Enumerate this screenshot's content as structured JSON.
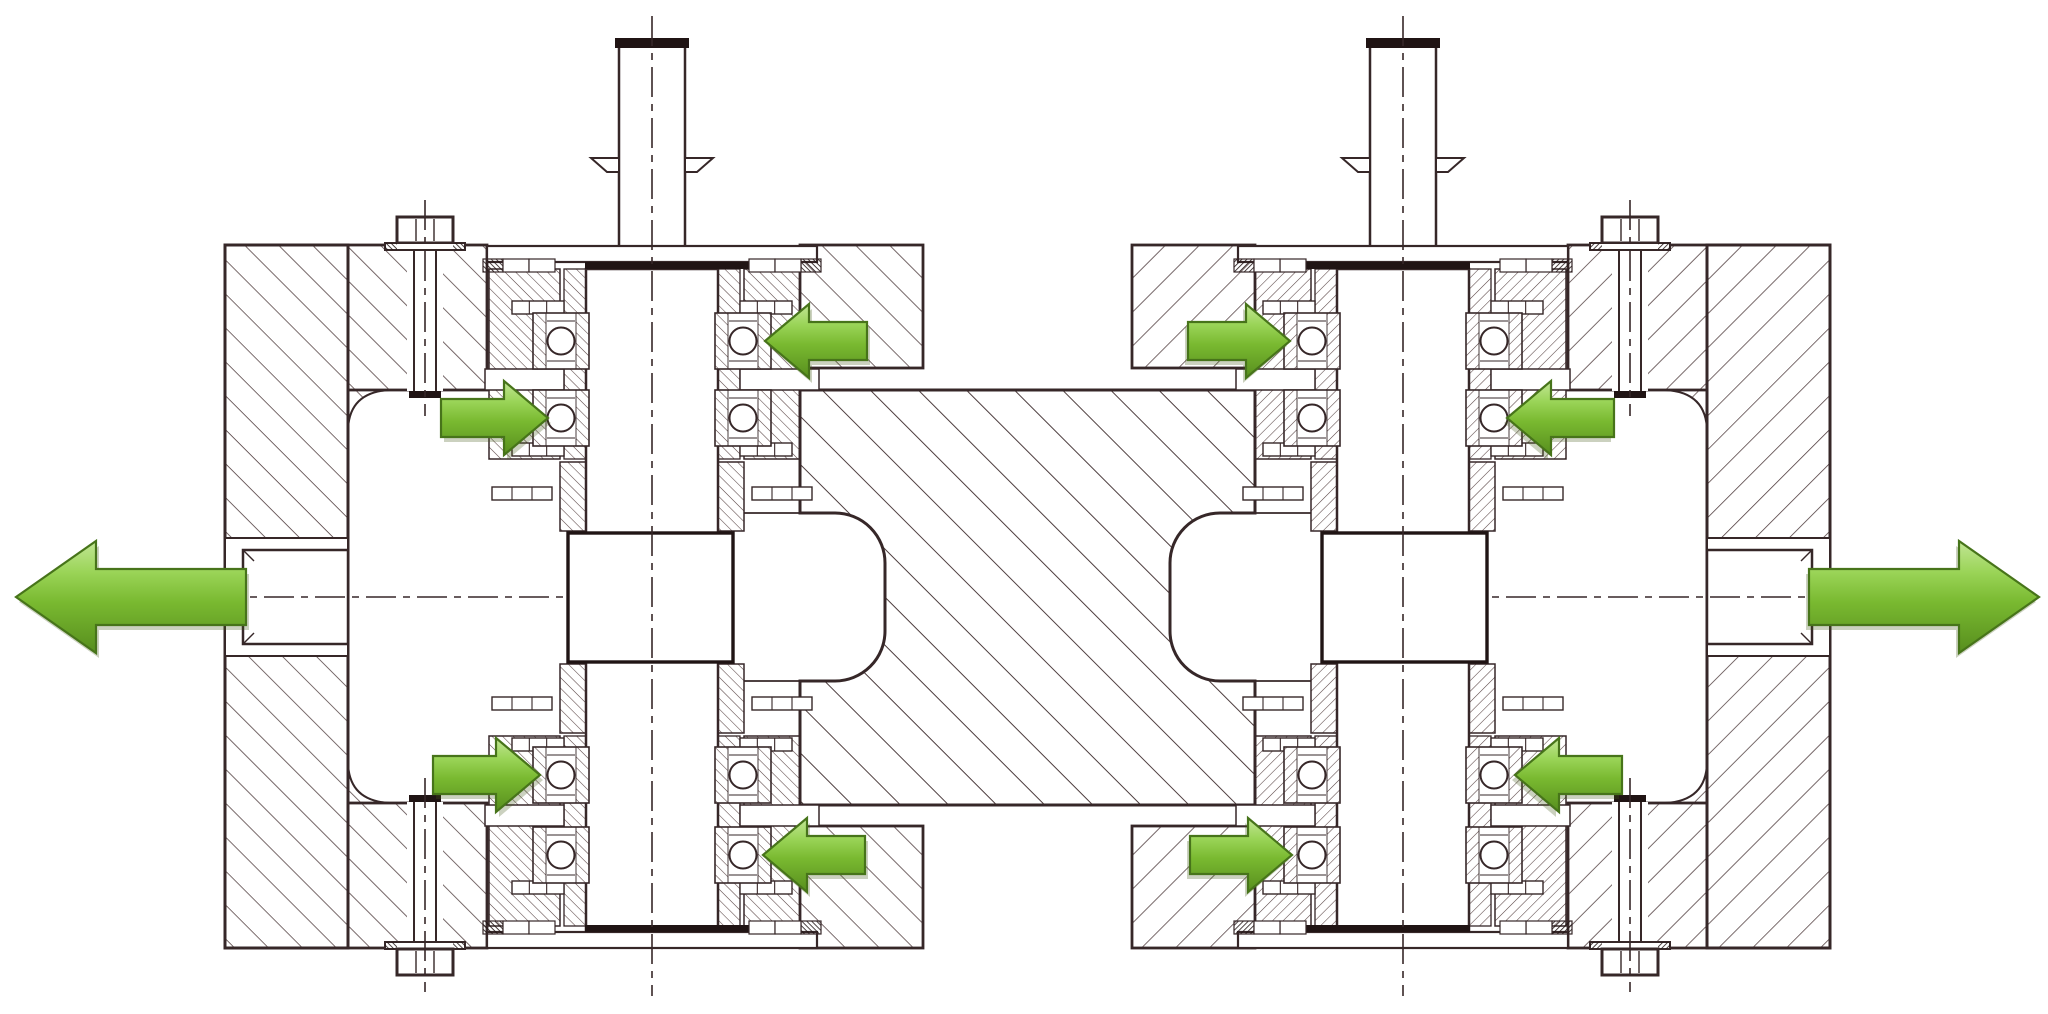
{
  "diagram": {
    "type": "engineering_cross_section",
    "subject": "Sectional drawing of a symmetric twin-shaft four-bearing test rig with green force-flow arrows",
    "canvas": {
      "width": 2048,
      "height": 1014,
      "background": "#ffffff"
    },
    "colors": {
      "line": "#362728",
      "bold": "#201414",
      "hatch_coarse": "#4b3839",
      "hatch_block": "#443334",
      "hatch_fine": "#574242",
      "white": "#ffffff",
      "arrow_highlight": "#c2e695",
      "arrow_light": "#9ad457",
      "arrow_body": "#79b930",
      "arrow_shade": "#578e1e",
      "arrow_outline": "#47741a",
      "arrow_shadow": "rgba(70,90,25,0.28)"
    },
    "mirror_axis_x": 1027.5,
    "shafts": [
      {
        "id": "shaft-left",
        "center_x": 652
      },
      {
        "id": "shaft-right",
        "center_x": 1403,
        "mirrored_from": "shaft-left"
      }
    ],
    "bearing_rows_y": [
      341,
      418,
      775,
      855
    ],
    "ball_offset_x": 91,
    "ball_radius": 13.5,
    "axial_force_arrows": [
      {
        "id": "arrow-l1",
        "shaft": "shaft-left",
        "row_y": 341,
        "direction": "left",
        "tip_x": 765,
        "length": 102
      },
      {
        "id": "arrow-l2",
        "shaft": "shaft-left",
        "row_y": 418,
        "direction": "right",
        "tip_x": 548,
        "length": 107
      },
      {
        "id": "arrow-l3",
        "shaft": "shaft-left",
        "row_y": 775,
        "direction": "right",
        "tip_x": 540,
        "length": 107
      },
      {
        "id": "arrow-l4",
        "shaft": "shaft-left",
        "row_y": 855,
        "direction": "left",
        "tip_x": 763,
        "length": 102
      },
      {
        "id": "arrow-r1",
        "shaft": "shaft-right",
        "row_y": 341,
        "direction": "right",
        "tip_x": 1290,
        "length": 102,
        "mirrored_from": "arrow-l1"
      },
      {
        "id": "arrow-r2",
        "shaft": "shaft-right",
        "row_y": 418,
        "direction": "left",
        "tip_x": 1507,
        "length": 107,
        "mirrored_from": "arrow-l2"
      },
      {
        "id": "arrow-r3",
        "shaft": "shaft-right",
        "row_y": 775,
        "direction": "left",
        "tip_x": 1515,
        "length": 107,
        "mirrored_from": "arrow-l3"
      },
      {
        "id": "arrow-r4",
        "shaft": "shaft-right",
        "row_y": 855,
        "direction": "right",
        "tip_x": 1292,
        "length": 102,
        "mirrored_from": "arrow-l4"
      }
    ],
    "radial_force_arrows": [
      {
        "id": "arrow-load-left",
        "direction": "left",
        "tip_x": 16,
        "tip_y": 597,
        "length": 230
      },
      {
        "id": "arrow-load-right",
        "direction": "right",
        "tip_x": 2039,
        "tip_y": 597,
        "length": 230,
        "mirrored_from": "arrow-load-left"
      }
    ],
    "small_arrow_size": {
      "body_half_height": 19,
      "head_half_height": 37,
      "head_length": 44
    },
    "large_arrow_size": {
      "body_half_height": 28,
      "head_half_height": 56,
      "head_length": 80
    },
    "housing": {
      "outer_top_y": 245,
      "outer_bottom_y": 948,
      "wall": {
        "x": 225,
        "width": 123
      },
      "arm_inner": {
        "x": 348,
        "width": 139
      },
      "arm_outer": {
        "x": 800,
        "width": 123,
        "bottom_y": 368
      },
      "rod_slot": {
        "y": 538,
        "height": 118
      },
      "rod": {
        "x": 243,
        "y": 550,
        "width": 105,
        "height": 94
      },
      "bolt_center_x": 425,
      "window": {
        "y1": 390,
        "y2": 803
      }
    },
    "center_block": {
      "x1": 800,
      "x2": 1255,
      "y1": 390,
      "y2": 805,
      "cutout": {
        "corner_x": 835,
        "outer_x": 885,
        "y1": 513,
        "y2": 681,
        "radius": 50
      }
    },
    "cartridge": {
      "x1": 487,
      "x2": 817,
      "flange_top_y": 246,
      "flange_h": 16
    },
    "drum": {
      "x": 568,
      "width": 165,
      "y": 533,
      "height": 129
    },
    "shaft_top": {
      "x": 619,
      "width": 66,
      "top_y": 46,
      "tab_y": 158
    },
    "components": [
      "outer-housing-left",
      "outer-housing-right",
      "center-block",
      "shaft-left",
      "shaft-right",
      "ball-bearings-x16",
      "clamp-bolts-x4",
      "load-rod-left",
      "load-rod-right",
      "axial-force-arrows-x8",
      "radial-load-arrows-x2"
    ]
  }
}
